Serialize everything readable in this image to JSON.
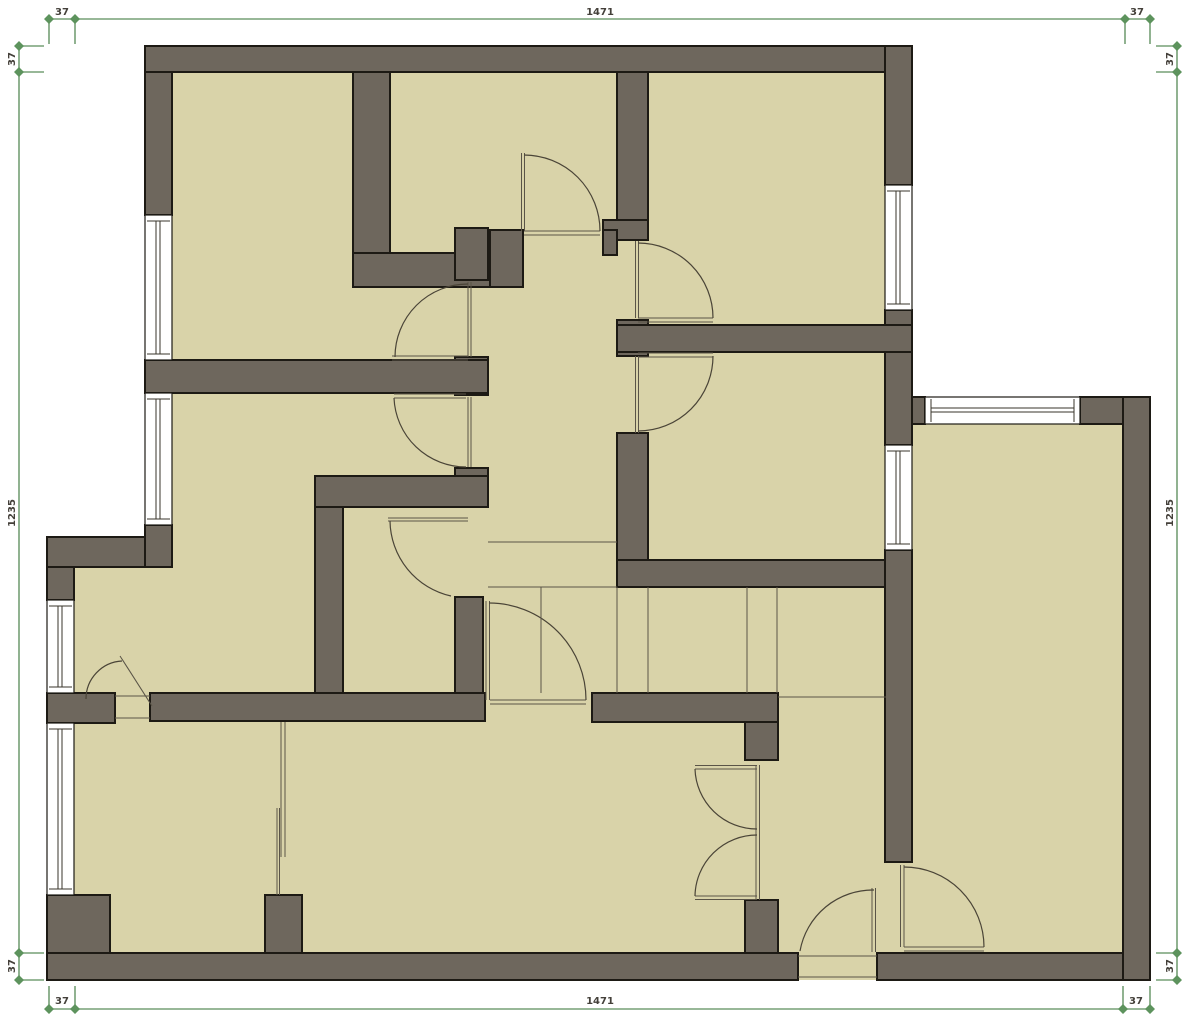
{
  "drawing": {
    "type": "floor-plan",
    "view": "2d-top-down"
  },
  "dimensions": {
    "top": [
      "37",
      "1471",
      "37"
    ],
    "bottom": [
      "37",
      "1471",
      "37"
    ],
    "left": [
      "37",
      "1235",
      "37"
    ],
    "right": [
      "37",
      "1235",
      "37"
    ]
  },
  "colors": {
    "wall_fill": "#6e675d",
    "wall_outline": "#1d1a14",
    "floor_fill": "#d9d3a9",
    "window_fill": "#ffffff",
    "dimension_green": "#76a076",
    "background": "#ffffff"
  }
}
